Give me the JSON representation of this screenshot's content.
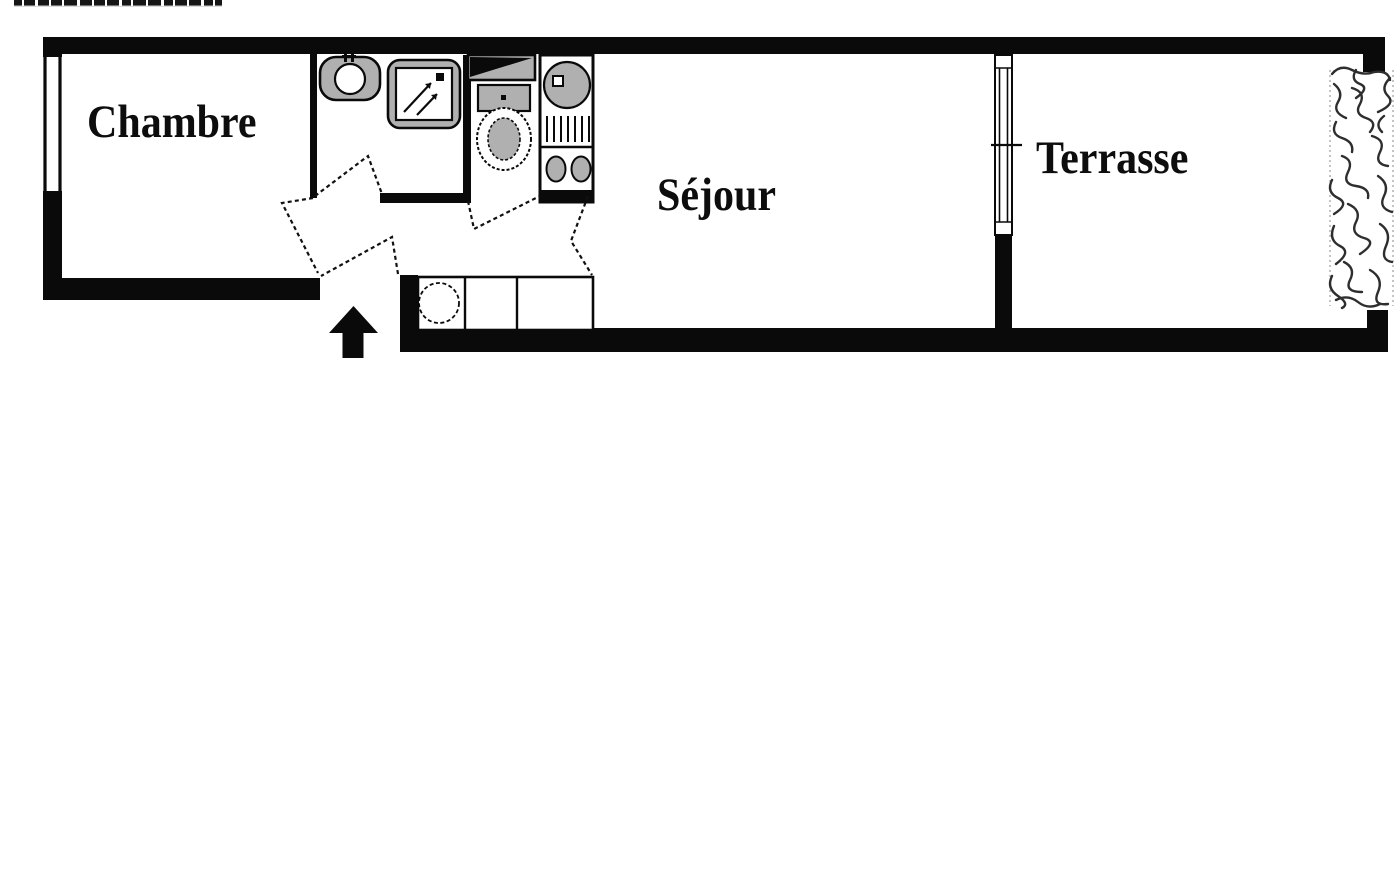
{
  "plan": {
    "rooms": [
      {
        "name": "chambre",
        "label": "Chambre"
      },
      {
        "name": "sejour",
        "label": "Séjour"
      },
      {
        "name": "terrasse",
        "label": "Terrasse"
      }
    ],
    "fixtures": [
      "washbasin",
      "shower-tray",
      "shelf-unit",
      "toilet",
      "kitchenette-sink",
      "kitchenette-drainer",
      "kitchenette-burners",
      "counter-with-sink",
      "entrance-arrow",
      "hedge",
      "window-chambre",
      "window-terrasse"
    ],
    "doors": [
      "chambre-door",
      "bathroom-door",
      "entrance-door",
      "wc-door",
      "kitchen-door"
    ],
    "colors": {
      "wall": "#0a0a0a",
      "fixture_fill": "#b0b0b0",
      "background": "#ffffff",
      "hedge_stroke": "#2e2e2e"
    }
  }
}
